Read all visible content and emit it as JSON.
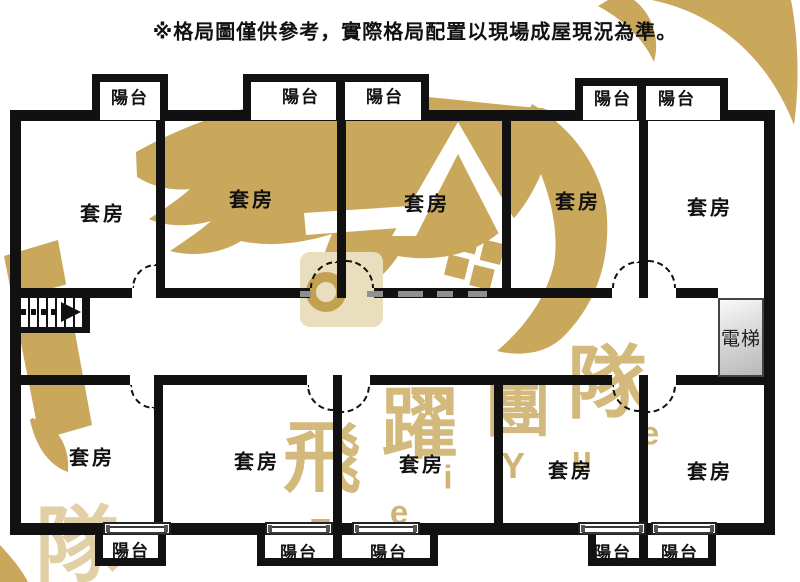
{
  "disclaimer": "※格局圖僅供參考，實際格局配置以現場成屋現況為準。",
  "colors": {
    "wall": "#111111",
    "watermark_gold": "#c9a85c",
    "watermark_pale": "#e9dfbf",
    "watermark_gray": "#8f8f8f",
    "elevator_fill_light": "#fafafa",
    "elevator_fill_dark": "#b9b9b9"
  },
  "elevator": {
    "label": "電梯"
  },
  "rooms": {
    "top": [
      {
        "label": "套房"
      },
      {
        "label": "套房"
      },
      {
        "label": "套房"
      },
      {
        "label": "套房"
      },
      {
        "label": "套房"
      }
    ],
    "bottom": [
      {
        "label": "套房"
      },
      {
        "label": "套房"
      },
      {
        "label": "套房"
      },
      {
        "label": "套房"
      },
      {
        "label": "套房"
      }
    ]
  },
  "balconies": {
    "top": [
      {
        "label": "陽台"
      },
      {
        "label": "陽台"
      },
      {
        "label": "陽台"
      },
      {
        "label": "陽台"
      },
      {
        "label": "陽台"
      }
    ],
    "bottom": [
      {
        "label": "陽台"
      },
      {
        "label": "陽台"
      },
      {
        "label": "陽台"
      },
      {
        "label": "陽台"
      },
      {
        "label": "陽台"
      }
    ]
  },
  "watermark": {
    "chars": [
      {
        "text": "飛"
      },
      {
        "text": "躍"
      },
      {
        "text": "團"
      },
      {
        "text": "隊"
      }
    ],
    "corner_char": "隊",
    "letters": [
      {
        "text": "F"
      },
      {
        "text": "e"
      },
      {
        "text": "i"
      },
      {
        "text": "Y"
      },
      {
        "text": "u"
      },
      {
        "text": "e"
      }
    ]
  }
}
